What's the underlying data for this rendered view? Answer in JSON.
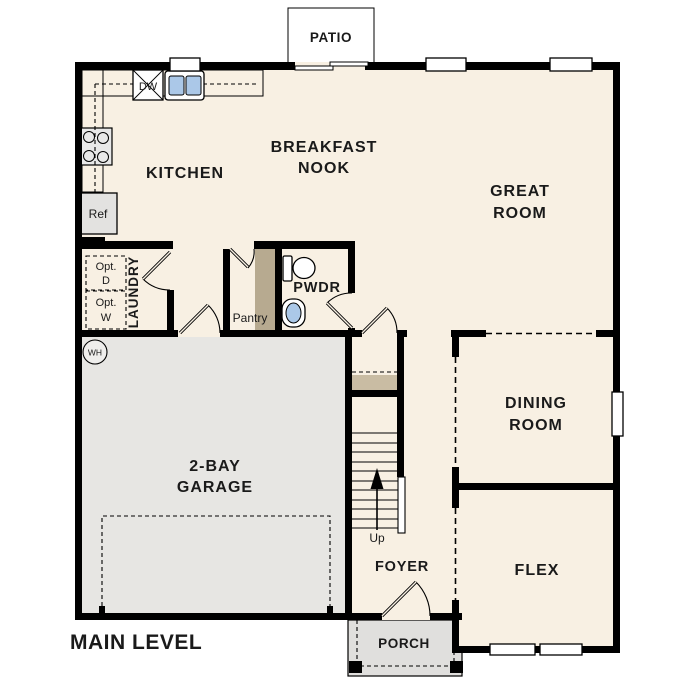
{
  "title": {
    "label": "MAIN LEVEL"
  },
  "colors": {
    "floor": "#f8f0e3",
    "garage_floor": "#e7e6e3",
    "outdoor_concrete": "#e0dfdd",
    "counter_tan": "#cec3ad",
    "shelf_tan": "#b7aa90",
    "stair_shelf_tan": "#c9bca3",
    "fixture_blue": "#abc8e8",
    "wall_black": "#000000",
    "text": "#1a1a1a",
    "background": "#ffffff"
  },
  "rooms": {
    "patio": "PATIO",
    "kitchen": "KITCHEN",
    "breakfast_nook_line1": "BREAKFAST",
    "breakfast_nook_line2": "NOOK",
    "great_room_line1": "GREAT",
    "great_room_line2": "ROOM",
    "laundry": "LAUNDRY",
    "pwdr": "PWDR",
    "pantry": "Pantry",
    "dining_line1": "DINING",
    "dining_line2": "ROOM",
    "garage_line1": "2-BAY",
    "garage_line2": "GARAGE",
    "foyer": "FOYER",
    "flex": "FLEX",
    "porch": "PORCH"
  },
  "fixtures": {
    "dishwasher": "DW",
    "refrigerator": "Ref",
    "opt_dryer_line1": "Opt.",
    "opt_dryer_line2": "D",
    "opt_washer_line1": "Opt.",
    "opt_washer_line2": "W",
    "water_heater": "WH",
    "stair_direction": "Up"
  }
}
